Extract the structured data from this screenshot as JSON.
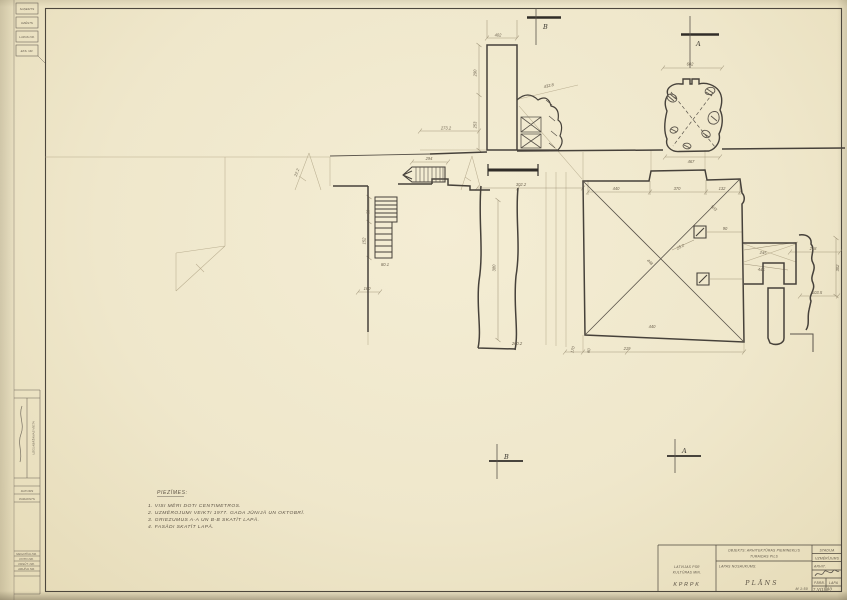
{
  "notes": {
    "heading": "PIEZĪMES:",
    "items": [
      "1. VISI MĒRI DOTI CENTIMETROS.",
      "2. UZMĒROJUMI VEIKTI 1977. GADA JŪNIJĀ UN OKTOBRĪ.",
      "3. GRIEZUMUS A-A UN B-B SKATĪT LAPĀ.",
      "4. FASĀDI SKATĪT LAPĀ."
    ]
  },
  "title_block": {
    "org_line1": "LATVIJAS PSR",
    "org_line2": "KULTŪRAS MIN.",
    "org_abbr": "KPRPK",
    "object_label": "OBJEKTS: ARHITEKTŪRAS PIEMINEKLIS",
    "object_name": "TURAIDAS PILS",
    "sheet_label": "LAPAS NOSAUKUMS:",
    "sheet_title": "PLĀNS",
    "scale": "M 1:50",
    "stage_label": "STADIJA",
    "stage_value": "UZMĒRĪJUMS",
    "author_label": "ARHIT.",
    "check_label": "PĀRB.",
    "sheet_no_label": "LAPA",
    "date_value": "7.VIII-80"
  },
  "stamps": {
    "boxes": [
      "SAŅEMTS",
      "DZĒSTS",
      "LAPAS NR.",
      "EKS. NR."
    ]
  },
  "side_table": {
    "rotated_label": "UZGLABĀŠANAS VIETA",
    "small_rows": [
      "DATUMS",
      "PARAKSTS"
    ],
    "rows": [
      "NEGATĪVA NR.",
      "FOTO NR.",
      "PASŪT. NR.",
      "ARHĪVA NR."
    ]
  },
  "section_markers": [
    {
      "letter": "B"
    },
    {
      "letter": "A"
    },
    {
      "letter": "B"
    },
    {
      "letter": "A"
    }
  ],
  "drawing": {
    "dim_labels": [
      {
        "x": 498,
        "y": 36.5,
        "t": "402"
      },
      {
        "x": 476.5,
        "y": 73,
        "t": "290",
        "r": -90
      },
      {
        "x": 476.5,
        "y": 125,
        "t": "253",
        "r": -90
      },
      {
        "x": 446,
        "y": 129.5,
        "t": "273.2"
      },
      {
        "x": 549,
        "y": 87,
        "t": "432.8",
        "r": -12
      },
      {
        "x": 690,
        "y": 65.5,
        "t": "602"
      },
      {
        "x": 691,
        "y": 163,
        "t": "467"
      },
      {
        "x": 616,
        "y": 190,
        "t": "440"
      },
      {
        "x": 677,
        "y": 190,
        "t": "370"
      },
      {
        "x": 722,
        "y": 190,
        "t": "132"
      },
      {
        "x": 713,
        "y": 209,
        "t": "503",
        "r": 42
      },
      {
        "x": 649,
        "y": 263,
        "t": "448",
        "r": 45
      },
      {
        "x": 652,
        "y": 328,
        "t": "440"
      },
      {
        "x": 681,
        "y": 248,
        "t": "25.2",
        "r": -28
      },
      {
        "x": 725,
        "y": 230,
        "t": "90"
      },
      {
        "x": 763,
        "y": 254,
        "t": "245",
        "r": 7
      },
      {
        "x": 761,
        "y": 271,
        "t": "445",
        "r": 7
      },
      {
        "x": 813,
        "y": 250,
        "t": "218"
      },
      {
        "x": 817,
        "y": 294,
        "t": "103.5"
      },
      {
        "x": 839,
        "y": 268,
        "t": "302",
        "r": -90
      },
      {
        "x": 521,
        "y": 186,
        "t": "302.2"
      },
      {
        "x": 517,
        "y": 345,
        "t": "260.2"
      },
      {
        "x": 495.5,
        "y": 268,
        "t": "380",
        "r": -90
      },
      {
        "x": 365.5,
        "y": 241,
        "t": "152",
        "r": -90
      },
      {
        "x": 369.5,
        "y": 212,
        "t": "60",
        "r": -90
      },
      {
        "x": 385,
        "y": 266,
        "t": "80.1"
      },
      {
        "x": 367,
        "y": 290,
        "t": "160"
      },
      {
        "x": 298,
        "y": 173,
        "t": "22.2",
        "r": -70
      },
      {
        "x": 429,
        "y": 160,
        "t": "294"
      },
      {
        "x": 574,
        "y": 350,
        "t": "170",
        "r": -75
      },
      {
        "x": 590,
        "y": 351,
        "t": "60",
        "r": -75
      },
      {
        "x": 627,
        "y": 350,
        "t": "219"
      }
    ]
  }
}
